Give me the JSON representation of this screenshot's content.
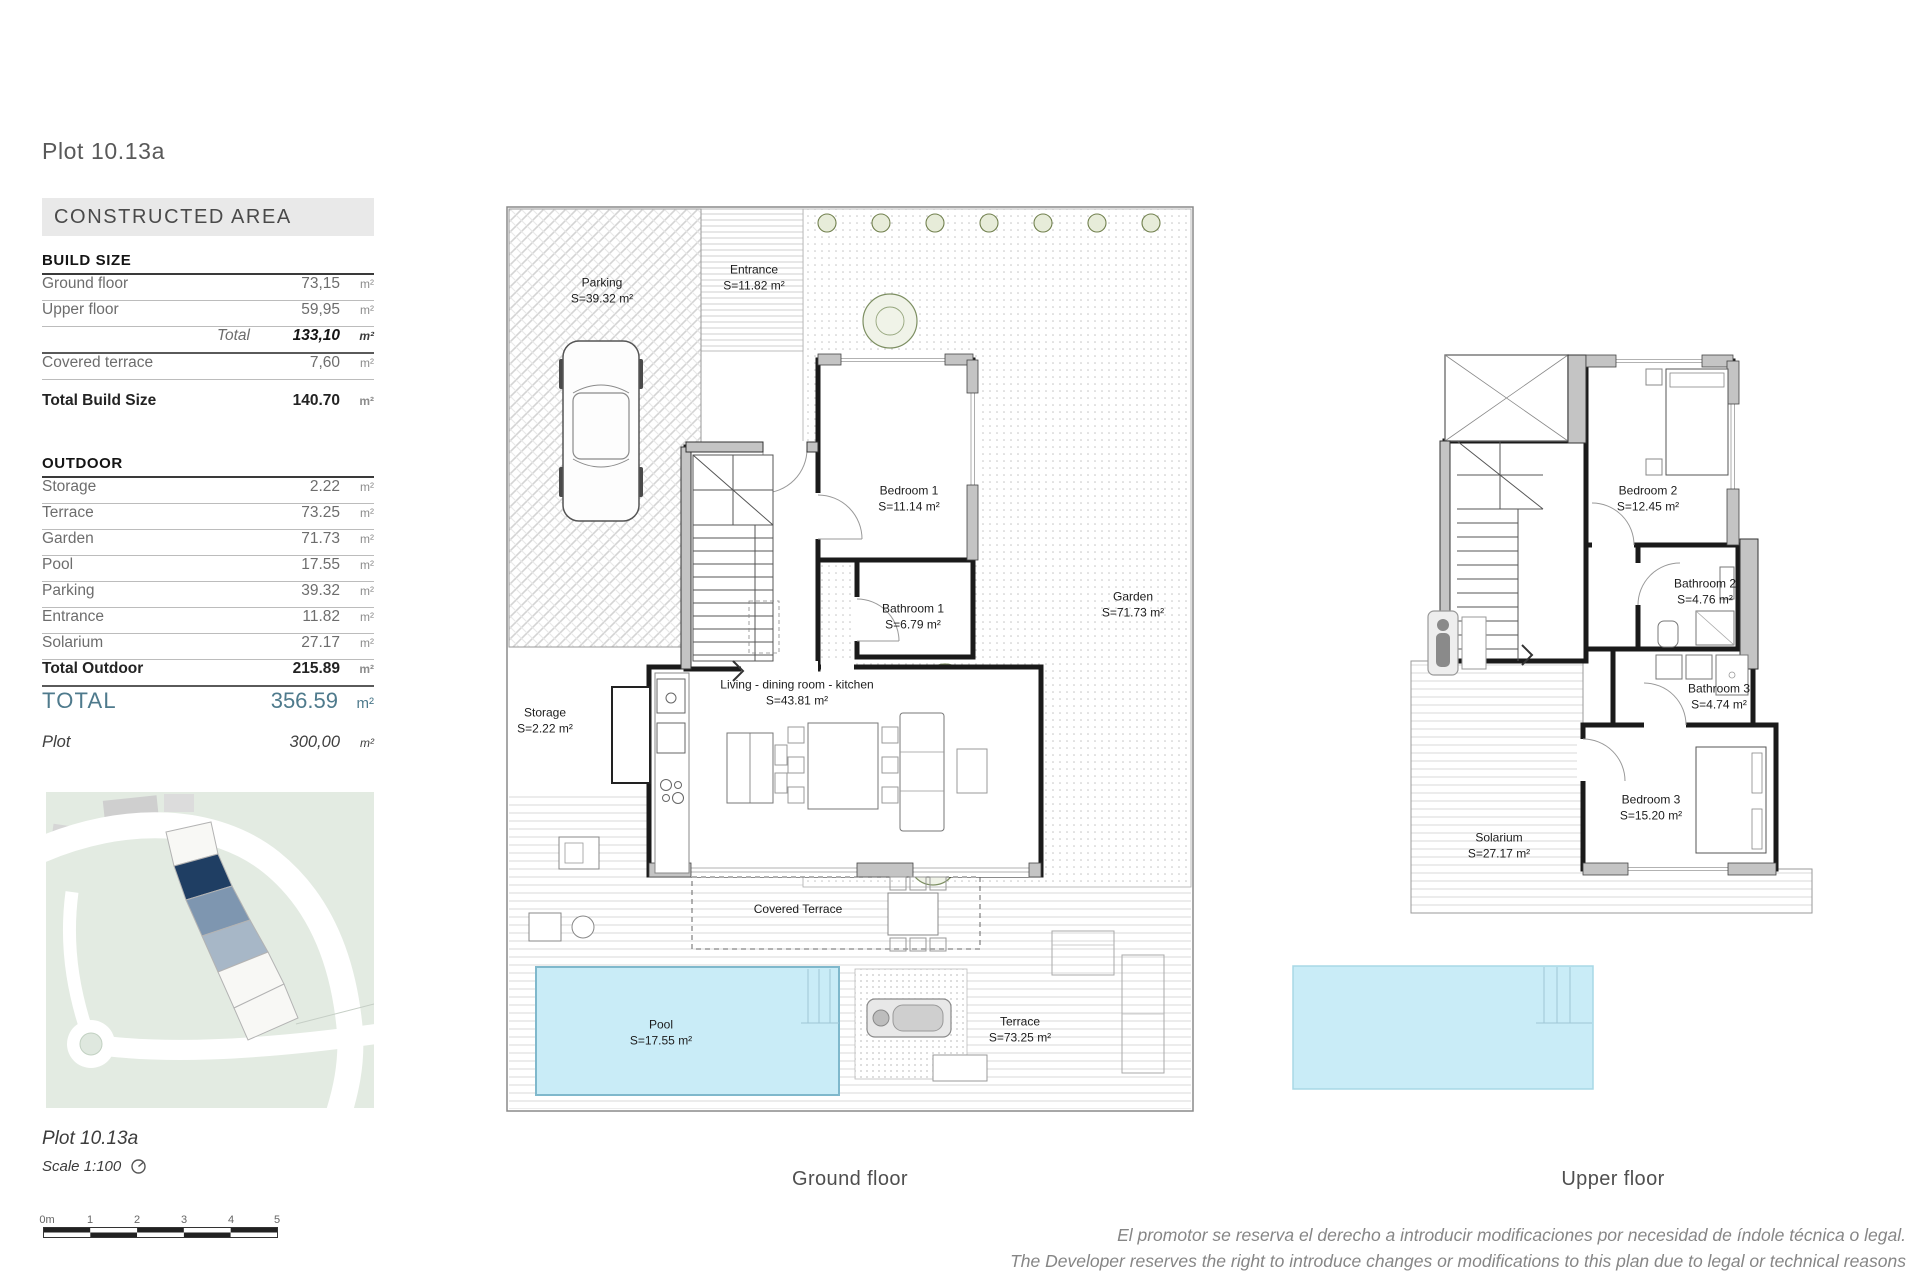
{
  "sheet": {
    "title": "Plot 10.13a"
  },
  "area_table": {
    "banner": "CONSTRUCTED AREA",
    "build_size": {
      "heading": "BUILD SIZE",
      "rows": [
        {
          "label": "Ground floor",
          "value": "73,15",
          "unit": "m²"
        },
        {
          "label": "Upper floor",
          "value": "59,95",
          "unit": "m²"
        }
      ],
      "total": {
        "label": "Total",
        "value": "133,10",
        "unit": "m²"
      },
      "covered": {
        "label": "Covered terrace",
        "value": "7,60",
        "unit": "m²"
      },
      "total_build": {
        "label": "Total Build Size",
        "value": "140.70",
        "unit": "m²"
      }
    },
    "outdoor": {
      "heading": "OUTDOOR",
      "rows": [
        {
          "label": "Storage",
          "value": "2.22",
          "unit": "m²"
        },
        {
          "label": "Terrace",
          "value": "73.25",
          "unit": "m²"
        },
        {
          "label": "Garden",
          "value": "71.73",
          "unit": "m²"
        },
        {
          "label": "Pool",
          "value": "17.55",
          "unit": "m²"
        },
        {
          "label": "Parking",
          "value": "39.32",
          "unit": "m²"
        },
        {
          "label": "Entrance",
          "value": "11.82",
          "unit": "m²"
        },
        {
          "label": "Solarium",
          "value": "27.17",
          "unit": "m²"
        }
      ],
      "total": {
        "label": "Total Outdoor",
        "value": "215.89",
        "unit": "m²"
      }
    },
    "grand_total": {
      "label": "TOTAL",
      "value": "356.59",
      "unit": "m²"
    },
    "plot": {
      "label": "Plot",
      "value": "300,00",
      "unit": "m²"
    }
  },
  "ground_floor": {
    "caption": "Ground floor",
    "rooms": {
      "parking": {
        "name": "Parking",
        "area": "S=39.32 m²"
      },
      "entrance": {
        "name": "Entrance",
        "area": "S=11.82 m²"
      },
      "garden": {
        "name": "Garden",
        "area": "S=71.73 m²"
      },
      "bedroom1": {
        "name": "Bedroom 1",
        "area": "S=11.14 m²"
      },
      "bathroom1": {
        "name": "Bathroom 1",
        "area": "S=6.79 m²"
      },
      "living": {
        "name": "Living - dining  room - kitchen",
        "area": "S=43.81 m²"
      },
      "storage": {
        "name": "Storage",
        "area": "S=2.22 m²"
      },
      "covered_terrace": {
        "name": "Covered Terrace"
      },
      "pool": {
        "name": "Pool",
        "area": "S=17.55 m²"
      },
      "terrace": {
        "name": "Terrace",
        "area": "S=73.25 m²"
      }
    }
  },
  "upper_floor": {
    "caption": "Upper floor",
    "rooms": {
      "bedroom2": {
        "name": "Bedroom 2",
        "area": "S=12.45 m²"
      },
      "bathroom2": {
        "name": "Bathroom 2",
        "area": "S=4.76 m²"
      },
      "bathroom3": {
        "name": "Bathroom 3",
        "area": "S=4.74 m²"
      },
      "bedroom3": {
        "name": "Bedroom 3",
        "area": "S=15.20 m²"
      },
      "solarium": {
        "name": "Solarium",
        "area": "S=27.17 m²"
      }
    }
  },
  "footer": {
    "plot_label": "Plot 10.13a",
    "scale_label": "Scale 1:100",
    "scale_ticks": [
      "0m",
      "1",
      "2",
      "3",
      "4",
      "5"
    ],
    "disclaimer_es": "El promotor se reserva el derecho a introducir modificaciones por necesidad de índole técnica o legal.",
    "disclaimer_en": "The Developer reserves the right to introduce changes or modifications to this plan due to legal or technical reasons"
  },
  "colors": {
    "accent_total": "#4e7a8c",
    "pool_fill": "#c9ecf7",
    "site_plan_bg": "#e3ebe2",
    "plot_highlight": "#1f3e63",
    "plot_adjacent": "#7e96b0",
    "wall": "#1a1a1a"
  }
}
